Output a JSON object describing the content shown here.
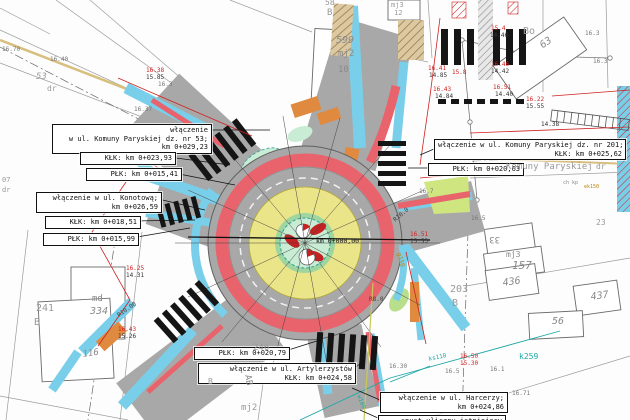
{
  "title": "Plan sytuacyjny ronda - włączenia ulic",
  "colors": {
    "asphalt": "#a8a8a8",
    "red_band": "#e8636c",
    "apron_yellow": "#ebe58a",
    "island_green": "#b9df8c",
    "island_mint": "#c8ecd4",
    "sidewalk_cyan": "#79cfe9",
    "paving_orange": "#df8a3f",
    "utility_red": "#cf2020",
    "utility_teal": "#1fa8a8",
    "cadastral_gray": "#999999",
    "tan_edge": "#d8bf7e"
  },
  "callouts": [
    {
      "id": "wlaczenie-komuny-paryskiej-53",
      "x": 52,
      "y": 124,
      "w": 152,
      "lines": [
        "włączenie",
        "w ul. Komuny Paryskiej dz. nr 53;",
        "km 0+029,23"
      ]
    },
    {
      "id": "klk-023-93",
      "x": 80,
      "y": 152,
      "w": 88,
      "lines": [
        "KŁK: km 0+023,93"
      ]
    },
    {
      "id": "plk-015-41",
      "x": 86,
      "y": 168,
      "w": 88,
      "lines": [
        "PŁK: km 0+015,41"
      ]
    },
    {
      "id": "wlaczenie-konotowa",
      "x": 36,
      "y": 192,
      "w": 118,
      "lines": [
        "włączenie w ul. Konotową;",
        "km 0+026,59"
      ]
    },
    {
      "id": "klk-018-51",
      "x": 45,
      "y": 216,
      "w": 88,
      "lines": [
        "KŁK: km 0+018,51"
      ]
    },
    {
      "id": "plk-015-99",
      "x": 43,
      "y": 233,
      "w": 88,
      "lines": [
        "PŁK: km 0+015,99"
      ]
    },
    {
      "id": "wlaczenie-komuny-paryskiej-201",
      "x": 434,
      "y": 139,
      "w": 184,
      "lines": [
        "włączenie w ul. Komuny Paryskiej dz. nr 201;",
        "KŁK: km 0+025,62"
      ]
    },
    {
      "id": "plk-020-63",
      "x": 428,
      "y": 163,
      "w": 88,
      "lines": [
        "PŁK: km 0+020,63"
      ]
    },
    {
      "id": "plk-020-79",
      "x": 194,
      "y": 347,
      "w": 88,
      "lines": [
        "PŁK: km 0+020,79"
      ]
    },
    {
      "id": "wlaczenie-artylerzystow",
      "x": 198,
      "y": 363,
      "w": 150,
      "lines": [
        "włączenie w ul. Artylerzystów",
        "KŁK: km 0+024,58"
      ]
    },
    {
      "id": "wlaczenie-harcerzy",
      "x": 380,
      "y": 392,
      "w": 120,
      "lines": [
        "włączenie w ul. Harcerzy;",
        "km 0+024,86"
      ]
    },
    {
      "id": "spust-uliczny",
      "x": 378,
      "y": 415,
      "w": 120,
      "lines": [
        "spust uliczny istniejący"
      ]
    }
  ],
  "map_texts": [
    {
      "t": "Komuny Paryskiej",
      "x": 506,
      "y": 162,
      "s": 9,
      "c": "#9a9a9a"
    },
    {
      "t": "dr",
      "x": 596,
      "y": 162,
      "s": 8,
      "c": "#9a9a9a"
    },
    {
      "t": "ch kp",
      "x": 563,
      "y": 180,
      "s": 5,
      "c": "#8a8a8a"
    },
    {
      "t": "ek150",
      "x": 584,
      "y": 184,
      "s": 5,
      "c": "#b8860b"
    },
    {
      "t": "km 0+000,00",
      "x": 316,
      "y": 237,
      "s": 6.5,
      "c": "#111"
    },
    {
      "t": "07",
      "x": 2,
      "y": 176,
      "s": 7,
      "c": "#9a9a9a"
    },
    {
      "t": "dr",
      "x": 2,
      "y": 186,
      "s": 7,
      "c": "#9a9a9a"
    },
    {
      "t": "53",
      "x": 36,
      "y": 72,
      "s": 9,
      "c": "#9a9a9a",
      "i": true
    },
    {
      "t": "dr",
      "x": 47,
      "y": 84,
      "s": 8,
      "c": "#9a9a9a"
    },
    {
      "t": "58",
      "x": 325,
      "y": -2,
      "s": 8,
      "c": "#9a9a9a"
    },
    {
      "t": "B",
      "x": 327,
      "y": 8,
      "s": 9,
      "c": "#9a9a9a"
    },
    {
      "t": "599",
      "x": 336,
      "y": 35,
      "s": 10,
      "c": "#8a8a8a",
      "i": true
    },
    {
      "t": "mj2",
      "x": 338,
      "y": 49,
      "s": 9,
      "c": "#8a8a8a"
    },
    {
      "t": "10",
      "x": 338,
      "y": 65,
      "s": 9,
      "c": "#8a8a8a"
    },
    {
      "t": "mj3",
      "x": 391,
      "y": 1,
      "s": 7,
      "c": "#9a9a9a"
    },
    {
      "t": "12",
      "x": 394,
      "y": 9,
      "s": 7,
      "c": "#9a9a9a"
    },
    {
      "t": "Bo",
      "x": 523,
      "y": 26,
      "s": 10,
      "c": "#9a9a9a"
    },
    {
      "t": "63",
      "x": 538,
      "y": 42,
      "s": 10,
      "c": "#8a8a8a",
      "i": true,
      "r": -35
    },
    {
      "t": "16.3",
      "x": 585,
      "y": 30,
      "s": 6,
      "c": "#777"
    },
    {
      "t": "16.3",
      "x": 593,
      "y": 58,
      "s": 6,
      "c": "#777"
    },
    {
      "t": "23",
      "x": 596,
      "y": 218,
      "s": 8,
      "c": "#9a9a9a"
    },
    {
      "t": "33",
      "x": 500,
      "y": 244,
      "s": 9,
      "c": "#8a8a8a",
      "r": 180
    },
    {
      "t": "mj3",
      "x": 506,
      "y": 250,
      "s": 8,
      "c": "#8a8a8a"
    },
    {
      "t": "157",
      "x": 512,
      "y": 259,
      "s": 11,
      "c": "#8a8a8a",
      "i": true
    },
    {
      "t": "436",
      "x": 502,
      "y": 278,
      "s": 10,
      "c": "#8a8a8a",
      "i": true,
      "r": -8
    },
    {
      "t": "437",
      "x": 590,
      "y": 292,
      "s": 10,
      "c": "#8a8a8a",
      "i": true,
      "r": -8
    },
    {
      "t": "56",
      "x": 552,
      "y": 316,
      "s": 10,
      "c": "#8a8a8a",
      "i": true
    },
    {
      "t": "203",
      "x": 450,
      "y": 284,
      "s": 10,
      "c": "#9a9a9a"
    },
    {
      "t": "B",
      "x": 452,
      "y": 298,
      "s": 10,
      "c": "#9a9a9a"
    },
    {
      "t": "241",
      "x": 36,
      "y": 303,
      "s": 10,
      "c": "#9a9a9a"
    },
    {
      "t": "B",
      "x": 34,
      "y": 317,
      "s": 10,
      "c": "#9a9a9a"
    },
    {
      "t": "md",
      "x": 92,
      "y": 294,
      "s": 9,
      "c": "#8a8a8a"
    },
    {
      "t": "334",
      "x": 90,
      "y": 306,
      "s": 10,
      "c": "#8a8a8a",
      "i": true
    },
    {
      "t": "116",
      "x": 82,
      "y": 350,
      "s": 9,
      "c": "#8a8a8a",
      "i": true,
      "r": -8
    },
    {
      "t": "246",
      "x": 253,
      "y": 343,
      "s": 9,
      "c": "#9a9a9a"
    },
    {
      "t": "B",
      "x": 208,
      "y": 377,
      "s": 8,
      "c": "#9a9a9a"
    },
    {
      "t": "mj2",
      "x": 241,
      "y": 403,
      "s": 9,
      "c": "#9a9a9a"
    },
    {
      "t": "AB",
      "x": 252,
      "y": 374,
      "s": 9,
      "c": "#8a8a8a",
      "r": 80
    },
    {
      "t": "k259",
      "x": 519,
      "y": 352,
      "s": 8,
      "c": "#1fa8a8"
    },
    {
      "t": "ks110",
      "x": 428,
      "y": 356,
      "s": 6,
      "c": "#1fa8a8",
      "r": -12
    },
    {
      "t": "w100",
      "x": 362,
      "y": 394,
      "s": 6,
      "c": "#1fa8a8",
      "r": 70
    },
    {
      "t": "g150",
      "x": 402,
      "y": 252,
      "s": 6,
      "c": "#b8860b",
      "r": 75
    },
    {
      "t": "R10.0",
      "x": 392,
      "y": 218,
      "s": 6,
      "c": "#444",
      "r": -40
    },
    {
      "t": "R10.00",
      "x": 116,
      "y": 313,
      "s": 6,
      "c": "#444",
      "r": -35
    },
    {
      "t": "R8.0",
      "x": 369,
      "y": 296,
      "s": 6,
      "c": "#444"
    },
    {
      "t": "16.41",
      "x": 428,
      "y": 65,
      "s": 6,
      "c": "#cf2020"
    },
    {
      "t": "14.85",
      "x": 429,
      "y": 72,
      "s": 6,
      "c": "#333"
    },
    {
      "t": "15.8",
      "x": 452,
      "y": 69,
      "s": 6,
      "c": "#cf2020"
    },
    {
      "t": "16.43",
      "x": 433,
      "y": 86,
      "s": 6,
      "c": "#cf2020"
    },
    {
      "t": "14.84",
      "x": 435,
      "y": 93,
      "s": 6,
      "c": "#333"
    },
    {
      "t": "16.46",
      "x": 491,
      "y": 61,
      "s": 6,
      "c": "#cf2020"
    },
    {
      "t": "14.42",
      "x": 491,
      "y": 68,
      "s": 6,
      "c": "#333"
    },
    {
      "t": "16.51",
      "x": 493,
      "y": 84,
      "s": 6,
      "c": "#cf2020"
    },
    {
      "t": "14.40",
      "x": 495,
      "y": 91,
      "s": 6,
      "c": "#333"
    },
    {
      "t": "15.4",
      "x": 491,
      "y": 25,
      "s": 6,
      "c": "#cf2020"
    },
    {
      "t": "14.46",
      "x": 490,
      "y": 32,
      "s": 6,
      "c": "#333"
    },
    {
      "t": "16.22",
      "x": 526,
      "y": 96,
      "s": 6,
      "c": "#cf2020"
    },
    {
      "t": "15.55",
      "x": 526,
      "y": 103,
      "s": 6,
      "c": "#333"
    },
    {
      "t": "14.38",
      "x": 541,
      "y": 121,
      "s": 6,
      "c": "#333"
    },
    {
      "t": "16.70",
      "x": 2,
      "y": 46,
      "s": 6,
      "c": "#777"
    },
    {
      "t": "16.40",
      "x": 50,
      "y": 56,
      "s": 6,
      "c": "#777"
    },
    {
      "t": "16.38",
      "x": 146,
      "y": 67,
      "s": 6,
      "c": "#cf2020"
    },
    {
      "t": "15.85",
      "x": 146,
      "y": 74,
      "s": 6,
      "c": "#333"
    },
    {
      "t": "16.3",
      "x": 158,
      "y": 81,
      "s": 6,
      "c": "#777"
    },
    {
      "t": "16.37",
      "x": 134,
      "y": 106,
      "s": 6,
      "c": "#777"
    },
    {
      "t": "16.25",
      "x": 126,
      "y": 265,
      "s": 6,
      "c": "#cf2020"
    },
    {
      "t": "14.31",
      "x": 126,
      "y": 272,
      "s": 6,
      "c": "#333"
    },
    {
      "t": "16.43",
      "x": 118,
      "y": 326,
      "s": 6,
      "c": "#cf2020"
    },
    {
      "t": "15.26",
      "x": 118,
      "y": 333,
      "s": 6,
      "c": "#333"
    },
    {
      "t": "16.50",
      "x": 460,
      "y": 353,
      "s": 6,
      "c": "#cf2020"
    },
    {
      "t": "15.30",
      "x": 460,
      "y": 360,
      "s": 6,
      "c": "#cf2020"
    },
    {
      "t": "16.51",
      "x": 410,
      "y": 231,
      "s": 6,
      "c": "#cf2020"
    },
    {
      "t": "15.53",
      "x": 410,
      "y": 238,
      "s": 6,
      "c": "#333"
    },
    {
      "t": "16.7",
      "x": 419,
      "y": 188,
      "s": 6,
      "c": "#777"
    },
    {
      "t": "16.5",
      "x": 471,
      "y": 215,
      "s": 6,
      "c": "#777"
    },
    {
      "t": "16.30",
      "x": 389,
      "y": 363,
      "s": 6,
      "c": "#777"
    },
    {
      "t": "16.5",
      "x": 445,
      "y": 368,
      "s": 6,
      "c": "#777"
    },
    {
      "t": "16.1",
      "x": 490,
      "y": 366,
      "s": 6,
      "c": "#777"
    },
    {
      "t": "16.71",
      "x": 512,
      "y": 390,
      "s": 6,
      "c": "#777"
    }
  ]
}
